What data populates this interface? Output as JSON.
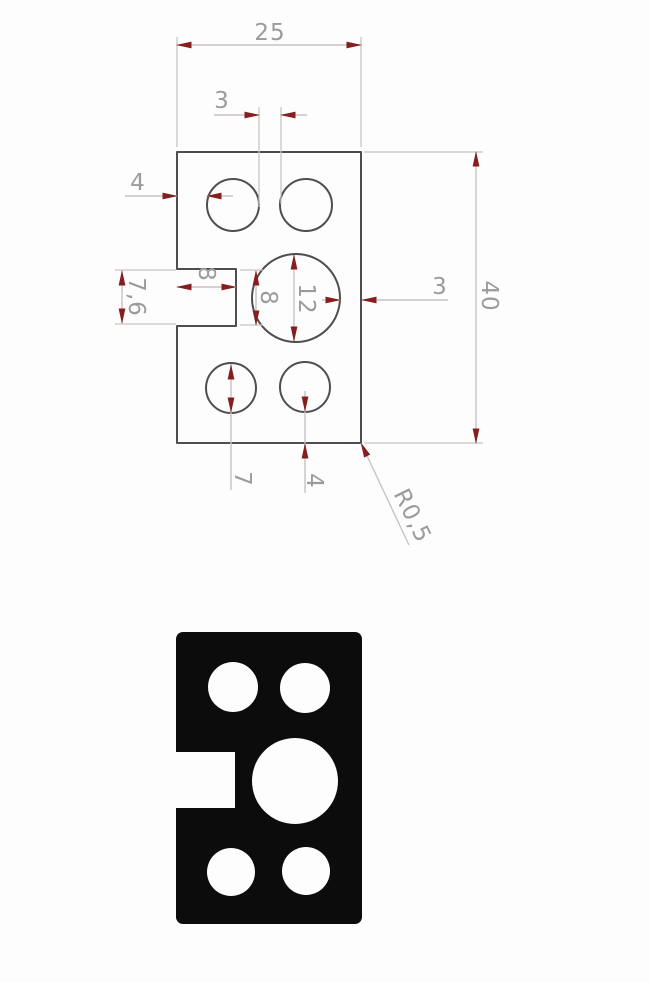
{
  "drawing": {
    "title": "dimensioned plate drawing with silhouette",
    "dims": {
      "width": "25",
      "top_hole_gap": "3",
      "left_edge_to_hole": "4",
      "notch_width": "8",
      "notch_height": "7,6",
      "slot_height": "8",
      "center_hole_dia": "12",
      "right_edge_gap": "3",
      "plate_height": "40",
      "bottom_hole_dia": "7",
      "bottom_edge_gap": "4",
      "corner_radius": "R0,5"
    },
    "colors": {
      "outline": "#4e4e4e",
      "dimension_line": "#c9c2c2",
      "arrowhead": "#851f1f",
      "dimension_text": "#9b9b9b",
      "silhouette_fill": "#0c0c0c",
      "background": "#fdfdfd"
    }
  }
}
